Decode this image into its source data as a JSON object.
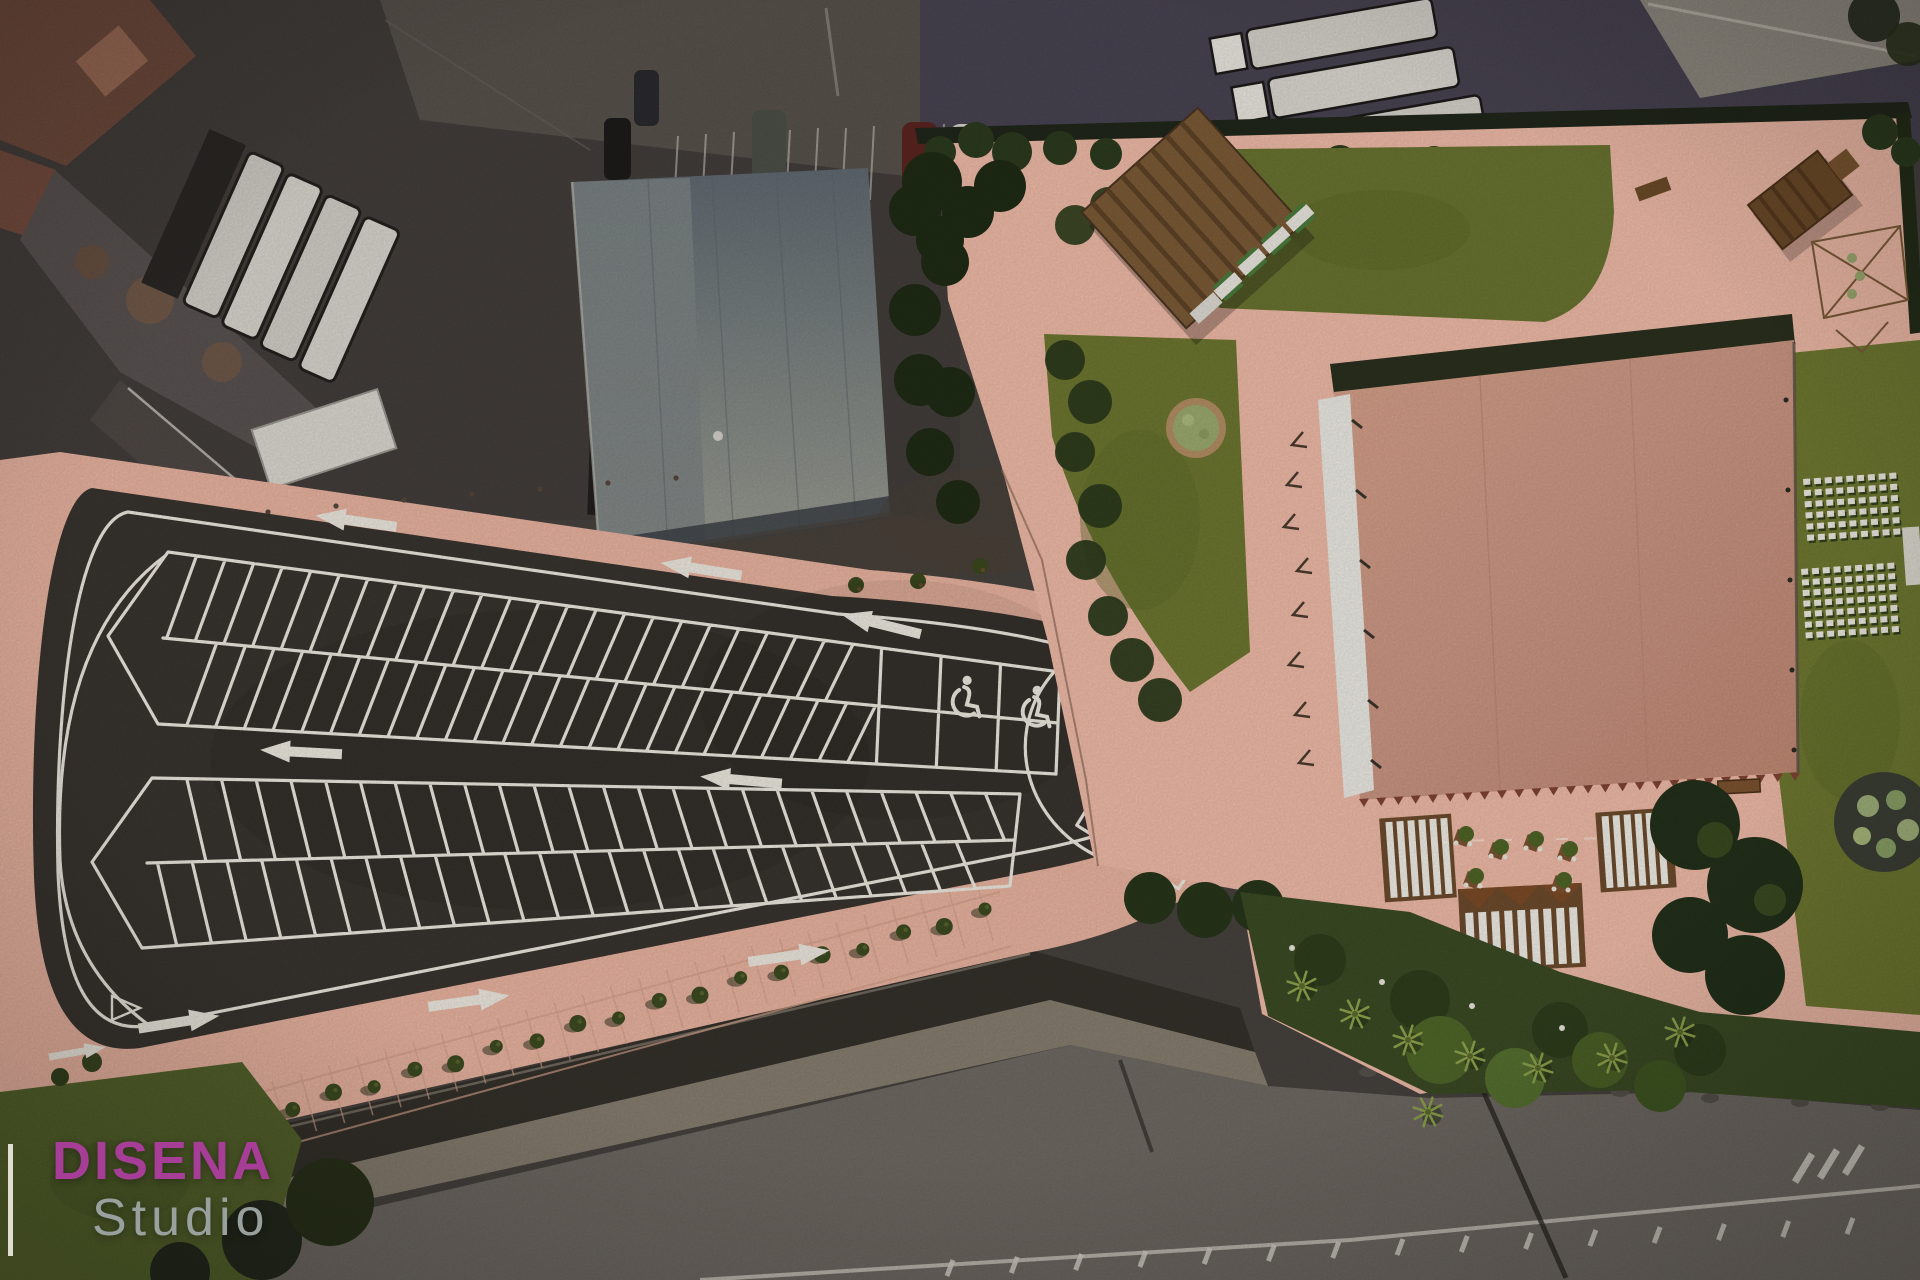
{
  "watermark": {
    "brand": "DISENA",
    "studio": "Studio",
    "brand_color": "#a63d96",
    "studio_color": "#99a19e"
  },
  "palette": {
    "asphalt": "#38332e",
    "paint_line": "#eae6dc",
    "parking_pavement": "#e6b19e",
    "venue_pavement": "#ecb8a5",
    "roof": "#ca9580",
    "marquee_white": "#e9e7e0",
    "lawn": "#6b752f",
    "hedge": "#242e18",
    "satellite_road": "#6e6862"
  },
  "render": {
    "parking": {
      "islands": [
        {
          "tip": [
            108,
            636
          ],
          "TL": [
            168,
            552
          ],
          "TR": [
            1060,
            672
          ],
          "BR": [
            1056,
            774
          ],
          "BL": [
            158,
            724
          ],
          "n": 24,
          "lean": 0.028,
          "tMax": 0.8,
          "hDiv": 3
        },
        {
          "tip": [
            92,
            862
          ],
          "TL": [
            152,
            778
          ],
          "TR": [
            1020,
            794
          ],
          "BR": [
            1010,
            886
          ],
          "BL": [
            142,
            948
          ],
          "n": 24,
          "lean": -0.028,
          "tMax": 1
        }
      ],
      "handicap_spaces": [
        [
          962,
          696,
          6
        ],
        [
          1032,
          706,
          6
        ],
        [
          1160,
          826,
          30
        ]
      ],
      "arrows": [
        {
          "x": 355,
          "y": 521,
          "r": 8
        },
        {
          "x": 700,
          "y": 569,
          "r": 9
        },
        {
          "x": 880,
          "y": 624,
          "r": 14
        },
        {
          "x": 300,
          "y": 752,
          "r": 3
        },
        {
          "x": 740,
          "y": 780,
          "r": 5
        },
        {
          "x": 180,
          "y": 1022,
          "r": 171
        },
        {
          "x": 470,
          "y": 1001,
          "r": 172
        },
        {
          "x": 790,
          "y": 956,
          "r": 172
        },
        {
          "x": 78,
          "y": 1052,
          "r": 170,
          "s": 0.7
        }
      ],
      "bollards": [
        [
          132,
          524
        ],
        [
          200,
          518
        ],
        [
          268,
          512
        ],
        [
          336,
          506
        ],
        [
          404,
          500
        ],
        [
          472,
          494
        ],
        [
          540,
          489
        ],
        [
          608,
          483
        ],
        [
          676,
          478
        ]
      ],
      "strip_trees": [
        [
          856,
          585
        ],
        [
          918,
          581
        ],
        [
          980,
          566
        ]
      ]
    },
    "promenade": {
      "x0": 252,
      "y0": 1118,
      "x1": 985,
      "y1": 912,
      "trees": 19,
      "slats": 26
    },
    "venue": {
      "chair_blocks": [
        {
          "x": 1803,
          "y": 479,
          "cols": 9,
          "rows": 6,
          "dx": 10.8,
          "dy": 11.2
        },
        {
          "x": 1801,
          "y": 569,
          "cols": 9,
          "rows": 7,
          "dx": 10.8,
          "dy": 10.6
        }
      ],
      "palm_trees": [
        [
          1302,
          986
        ],
        [
          1355,
          1014
        ],
        [
          1408,
          1040
        ],
        [
          1470,
          1056
        ],
        [
          1538,
          1068
        ],
        [
          1612,
          1058
        ],
        [
          1680,
          1032
        ],
        [
          1428,
          1112
        ]
      ],
      "roof_scallops": 26,
      "terrace_tables": [
        [
          1462,
          838
        ],
        [
          1497,
          851
        ],
        [
          1532,
          843
        ],
        [
          1566,
          853
        ],
        [
          1472,
          880
        ],
        [
          1560,
          884
        ]
      ],
      "tent_stake_marks": [
        [
          1303,
          432
        ],
        [
          1298,
          472
        ],
        [
          1295,
          514
        ],
        [
          1308,
          558
        ],
        [
          1304,
          602
        ],
        [
          1300,
          652
        ],
        [
          1306,
          702
        ],
        [
          1310,
          750
        ]
      ]
    },
    "road": {
      "hatches": 15,
      "rocks": [
        [
          1368,
          1072
        ],
        [
          1450,
          1082
        ],
        [
          1530,
          1090
        ],
        [
          1620,
          1092
        ],
        [
          1710,
          1098
        ],
        [
          1800,
          1102
        ],
        [
          1880,
          1106
        ]
      ]
    }
  }
}
